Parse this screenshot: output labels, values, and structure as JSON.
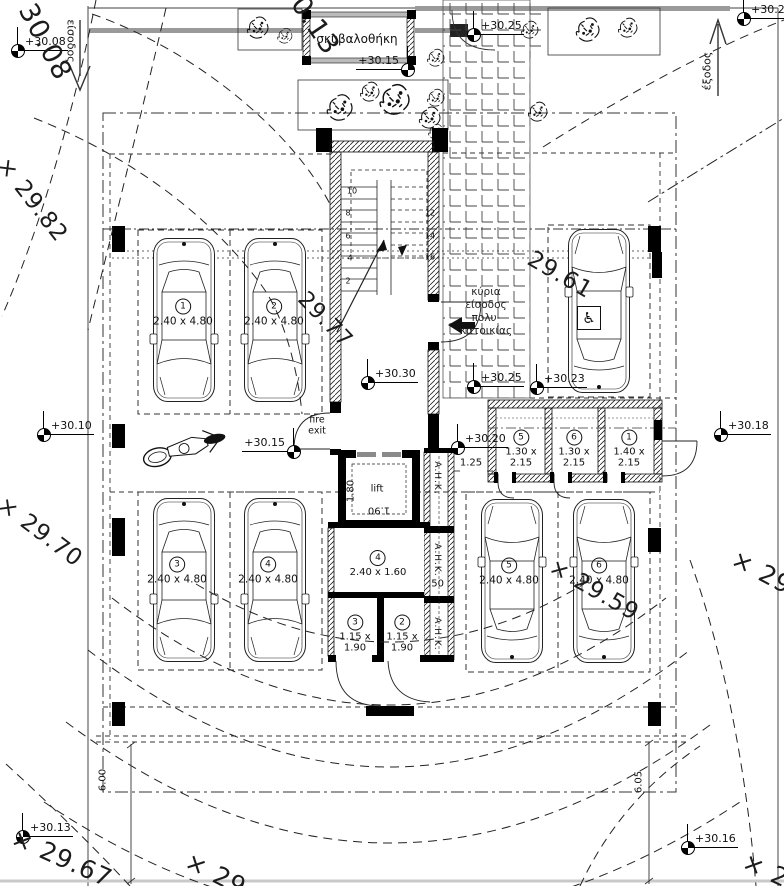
{
  "drawing": {
    "title": "ground floor parking plan",
    "language": "Greek"
  },
  "labels": {
    "garbage_room": "σκυβαλοθήκη",
    "entrance_arrow": "είσοδος",
    "exit_arrow": "έξοδος",
    "main_entrance_lines": [
      "κύρια",
      "είσοδος",
      "πολυ-",
      "κατοικίας"
    ],
    "lift": "lift",
    "fire_exit_lines": [
      "fire",
      "exit"
    ],
    "ahk": "Α.Η.Κ.",
    "wheelchair_icon": "♿"
  },
  "parking_spaces": [
    {
      "num": "1",
      "dims": "2.40 x 4.80",
      "x": 183,
      "y": 313
    },
    {
      "num": "2",
      "dims": "2.40 x 4.80",
      "x": 274,
      "y": 313
    },
    {
      "num": "3",
      "dims": "2.40 x 4.80",
      "x": 177,
      "y": 571
    },
    {
      "num": "4",
      "dims": "2.40 x 4.80",
      "x": 268,
      "y": 571
    },
    {
      "num": "5",
      "dims": "2.40 x 4.80",
      "x": 509,
      "y": 572
    },
    {
      "num": "6",
      "dims": "2.40 x 4.80",
      "x": 599,
      "y": 572
    }
  ],
  "storage_rooms": [
    {
      "num": "5",
      "lines": [
        "1.30 x",
        "2.15"
      ],
      "x": 521,
      "y": 449
    },
    {
      "num": "6",
      "lines": [
        "1.30 x",
        "2.15"
      ],
      "x": 574,
      "y": 449
    },
    {
      "num": "1",
      "lines": [
        "1.40 x",
        "2.15"
      ],
      "x": 629,
      "y": 449
    },
    {
      "num": "4",
      "lines": [
        "2.40 x 1.60"
      ],
      "x": 378,
      "y": 564
    },
    {
      "num": "3",
      "lines": [
        "1.15 x",
        "1.90"
      ],
      "x": 355,
      "y": 634
    },
    {
      "num": "2",
      "lines": [
        "1.15 x",
        "1.90"
      ],
      "x": 402,
      "y": 634
    }
  ],
  "elevation_markers": [
    {
      "label": "+30.08",
      "x": 17,
      "y": 50,
      "side": "right"
    },
    {
      "label": "+30.15",
      "x": 407,
      "y": 69,
      "side": "left"
    },
    {
      "label": "+30.25",
      "x": 473,
      "y": 34,
      "side": "right"
    },
    {
      "label": "+30.20",
      "x": 743,
      "y": 18,
      "side": "right"
    },
    {
      "label": "+30.10",
      "x": 43,
      "y": 434,
      "side": "right"
    },
    {
      "label": "+30.15",
      "x": 293,
      "y": 451,
      "side": "left"
    },
    {
      "label": "+30.30",
      "x": 367,
      "y": 382,
      "side": "right"
    },
    {
      "label": "+30.25",
      "x": 473,
      "y": 386,
      "side": "right"
    },
    {
      "label": "+30.23",
      "x": 536,
      "y": 387,
      "side": "right"
    },
    {
      "label": "+30.20",
      "x": 457,
      "y": 447,
      "side": "right"
    },
    {
      "label": "+30.18",
      "x": 720,
      "y": 434,
      "side": "right"
    },
    {
      "label": "+30.13",
      "x": 22,
      "y": 836,
      "side": "right"
    },
    {
      "label": "+30.16",
      "x": 687,
      "y": 847,
      "side": "right"
    }
  ],
  "contour_labels": [
    {
      "text": "30.08",
      "x": 45,
      "y": 42,
      "rot": 62,
      "size": 27
    },
    {
      "text": "30.13",
      "x": 310,
      "y": 18,
      "rot": 56,
      "size": 27
    },
    {
      "text": "× 29.82",
      "x": 32,
      "y": 200,
      "rot": 52,
      "size": 23
    },
    {
      "text": "29.77",
      "x": 325,
      "y": 320,
      "rot": 46,
      "size": 22
    },
    {
      "text": "× 29.70",
      "x": 40,
      "y": 532,
      "rot": 37,
      "size": 23
    },
    {
      "text": "29.61",
      "x": 560,
      "y": 275,
      "rot": 30,
      "size": 23
    },
    {
      "text": "× 29.59",
      "x": 594,
      "y": 590,
      "rot": 30,
      "size": 23
    },
    {
      "text": "× 29.67",
      "x": 62,
      "y": 858,
      "rot": 24,
      "size": 25
    },
    {
      "text": "× 29",
      "x": 216,
      "y": 874,
      "rot": 27,
      "size": 25
    },
    {
      "text": "× 29",
      "x": 762,
      "y": 572,
      "rot": 28,
      "size": 25
    },
    {
      "text": "× 2",
      "x": 766,
      "y": 870,
      "rot": 25,
      "size": 25
    }
  ],
  "stair_numbers": [
    {
      "n": "10",
      "x": 352,
      "y": 191
    },
    {
      "n": "8",
      "x": 348,
      "y": 213
    },
    {
      "n": "6",
      "x": 348,
      "y": 236
    },
    {
      "n": "4",
      "x": 350,
      "y": 258
    },
    {
      "n": "2",
      "x": 348,
      "y": 281
    },
    {
      "n": "12",
      "x": 430,
      "y": 213
    },
    {
      "n": "14",
      "x": 430,
      "y": 236
    },
    {
      "n": "16",
      "x": 430,
      "y": 257
    }
  ],
  "dim_labels": [
    {
      "text": "1.25",
      "x": 471,
      "y": 463,
      "rot": 0
    },
    {
      "text": ".50",
      "x": 436,
      "y": 584,
      "rot": 0
    },
    {
      "text": "1.80",
      "x": 351,
      "y": 491,
      "rot": -90
    },
    {
      "text": "1.90",
      "x": 379,
      "y": 510,
      "rot": 180
    },
    {
      "text": "6.00",
      "x": 103,
      "y": 780,
      "rot": -90
    },
    {
      "text": "6.05",
      "x": 639,
      "y": 782,
      "rot": -90
    }
  ],
  "ahk_positions": [
    {
      "x": 437,
      "y": 478
    },
    {
      "x": 437,
      "y": 560
    },
    {
      "x": 437,
      "y": 634
    }
  ]
}
